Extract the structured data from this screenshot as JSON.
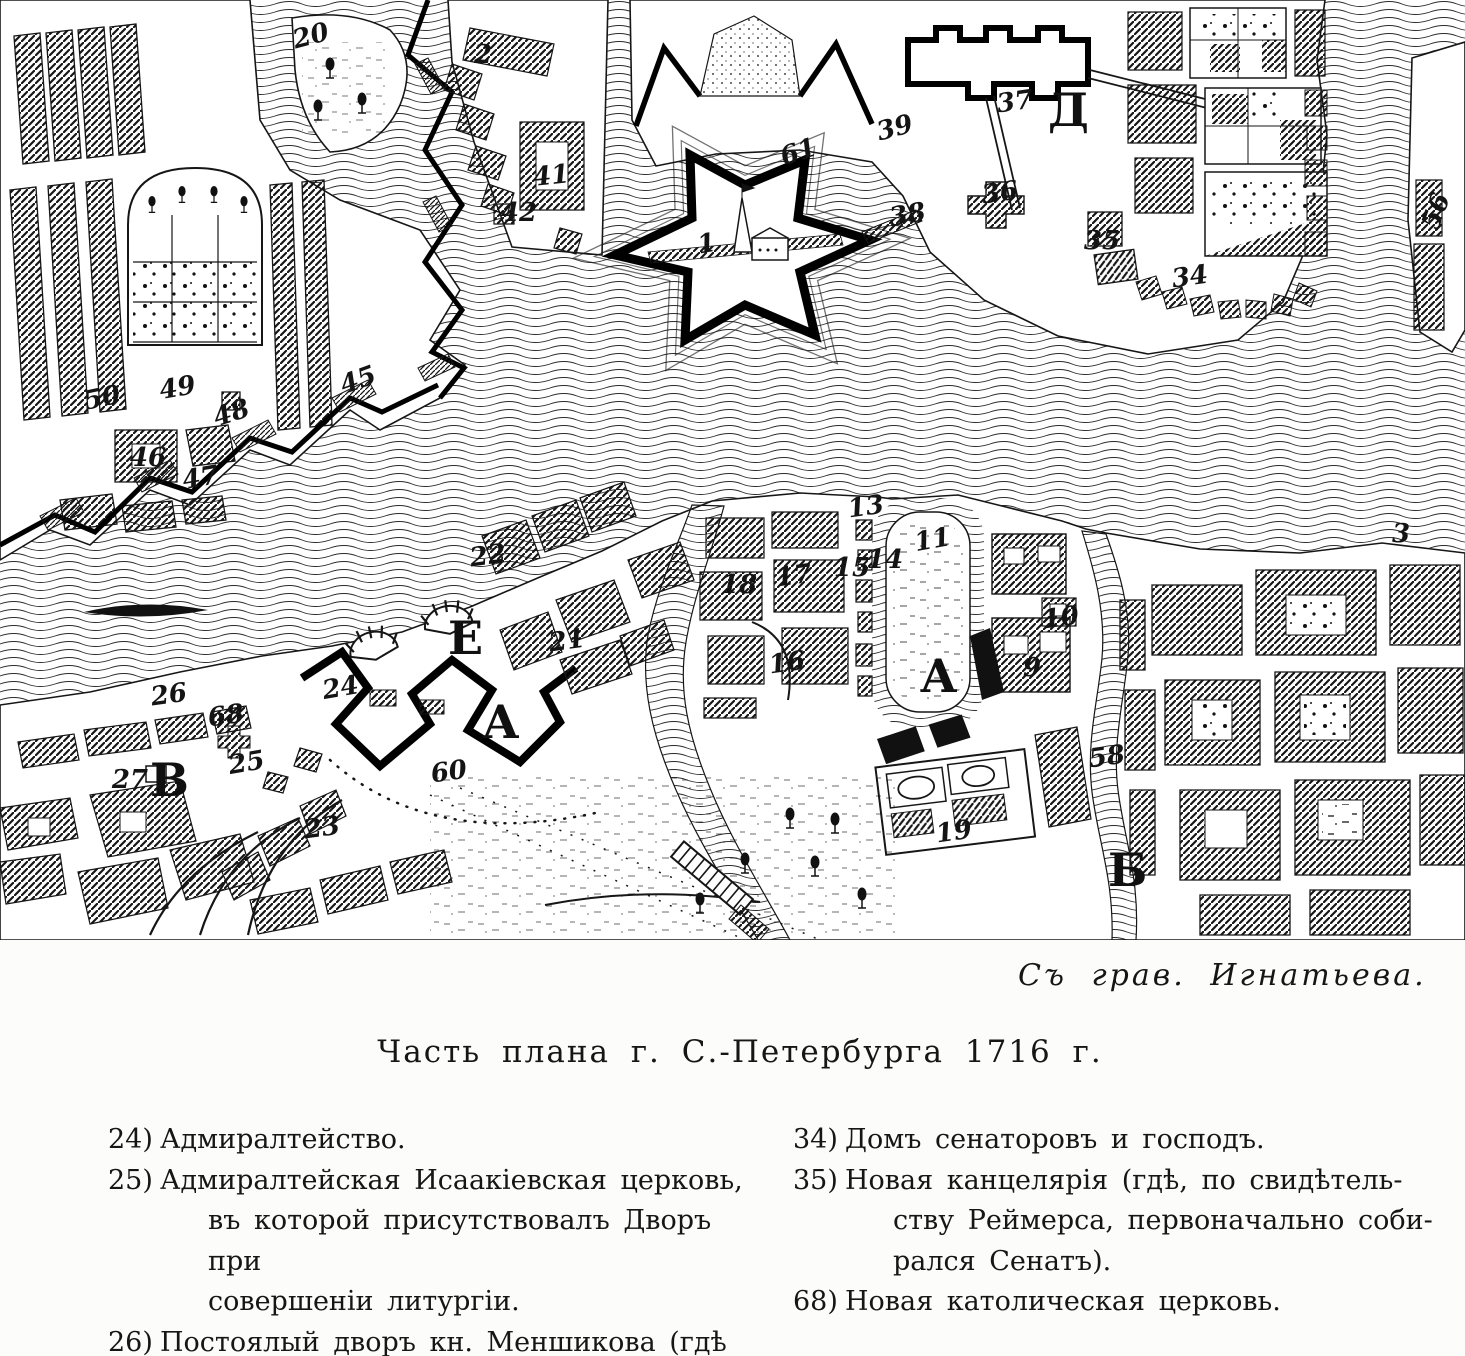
{
  "figure": {
    "attribution": "Съ грав. Игнатьева.",
    "title": "Часть плана г. С.-Петербурга 1716 г."
  },
  "colors": {
    "ink": "#161616",
    "paper": "#fcfcfa"
  },
  "legend": {
    "left": [
      {
        "num": "24)",
        "lines": [
          "Адмиралтейство."
        ]
      },
      {
        "num": "25)",
        "lines": [
          "Адмиралтейская Исаакіевская церковь,",
          "въ которой присутствовалъ Дворъ при",
          "совершеніи литургіи."
        ]
      },
      {
        "num": "26)",
        "lines": [
          "Постоялый дворъ кн. Меншикова (гдѣ",
          "нынѣ расположенъ Сенатъ)."
        ]
      }
    ],
    "right": [
      {
        "num": "34)",
        "lines": [
          "Домъ сенаторовъ и господъ."
        ]
      },
      {
        "num": "35)",
        "lines": [
          "Новая канцелярія (гдѣ, по свидѣтель-",
          "ству Реймерса, первоначально соби-",
          "рался Сенатъ)."
        ]
      },
      {
        "num": "68)",
        "lines": [
          "Новая католическая церковь."
        ]
      }
    ]
  },
  "map": {
    "labels": [
      {
        "t": "Д",
        "x": 1048,
        "y": 126,
        "k": "cap"
      },
      {
        "t": "Е",
        "x": 448,
        "y": 654,
        "k": "cap"
      },
      {
        "t": "А",
        "x": 482,
        "y": 738,
        "k": "cap"
      },
      {
        "t": "В",
        "x": 150,
        "y": 796,
        "k": "cap"
      },
      {
        "t": "А",
        "x": 920,
        "y": 692,
        "k": "cap",
        "s": 40
      },
      {
        "t": "Б",
        "x": 1108,
        "y": 886,
        "k": "cap"
      },
      {
        "t": "20",
        "x": 313,
        "y": 44,
        "k": "num",
        "r": -15
      },
      {
        "t": "2",
        "x": 483,
        "y": 63,
        "k": "num"
      },
      {
        "t": "41",
        "x": 552,
        "y": 184,
        "k": "num",
        "r": -6
      },
      {
        "t": "42",
        "x": 519,
        "y": 221,
        "k": "num"
      },
      {
        "t": "50",
        "x": 104,
        "y": 406,
        "k": "num",
        "r": -12
      },
      {
        "t": "49",
        "x": 179,
        "y": 396,
        "k": "num",
        "r": -10
      },
      {
        "t": "48",
        "x": 234,
        "y": 421,
        "k": "num",
        "r": -18
      },
      {
        "t": "46",
        "x": 148,
        "y": 466,
        "k": "num"
      },
      {
        "t": "47",
        "x": 202,
        "y": 486,
        "k": "num",
        "r": -10
      },
      {
        "t": "45",
        "x": 361,
        "y": 388,
        "k": "num",
        "r": -20
      },
      {
        "t": "1",
        "x": 708,
        "y": 252,
        "k": "num",
        "r": -10,
        "s": 30
      },
      {
        "t": "61",
        "x": 801,
        "y": 160,
        "k": "num",
        "r": -18,
        "s": 34
      },
      {
        "t": "39",
        "x": 897,
        "y": 136,
        "k": "num",
        "r": -15
      },
      {
        "t": "38",
        "x": 909,
        "y": 223,
        "k": "num",
        "r": -10
      },
      {
        "t": "37",
        "x": 1016,
        "y": 110,
        "k": "num",
        "r": -8,
        "s": 30
      },
      {
        "t": "36",
        "x": 1001,
        "y": 201,
        "k": "num",
        "r": -8
      },
      {
        "t": "35",
        "x": 1102,
        "y": 249,
        "k": "num",
        "s": 27
      },
      {
        "t": "34",
        "x": 1191,
        "y": 285,
        "k": "num",
        "r": -8,
        "s": 30
      },
      {
        "t": "56",
        "x": 1444,
        "y": 214,
        "k": "num",
        "r": -70
      },
      {
        "t": "3",
        "x": 1401,
        "y": 542,
        "k": "num"
      },
      {
        "t": "26",
        "x": 170,
        "y": 703,
        "k": "num",
        "r": -8
      },
      {
        "t": "68",
        "x": 227,
        "y": 724,
        "k": "num",
        "r": -8
      },
      {
        "t": "27",
        "x": 130,
        "y": 788,
        "k": "num"
      },
      {
        "t": "25",
        "x": 248,
        "y": 771,
        "k": "num",
        "r": -10
      },
      {
        "t": "23",
        "x": 323,
        "y": 836,
        "k": "num",
        "r": -8
      },
      {
        "t": "24",
        "x": 342,
        "y": 696,
        "k": "num",
        "r": -10
      },
      {
        "t": "60",
        "x": 450,
        "y": 780,
        "k": "num",
        "r": -8
      },
      {
        "t": "22",
        "x": 489,
        "y": 564,
        "k": "num",
        "r": -8
      },
      {
        "t": "21",
        "x": 568,
        "y": 649,
        "k": "num",
        "r": -8
      },
      {
        "t": "18",
        "x": 739,
        "y": 593,
        "k": "num"
      },
      {
        "t": "17",
        "x": 795,
        "y": 584,
        "k": "num",
        "r": -8
      },
      {
        "t": "15",
        "x": 852,
        "y": 576,
        "k": "num",
        "s": 22
      },
      {
        "t": "13",
        "x": 867,
        "y": 515,
        "k": "num",
        "r": -8,
        "s": 22
      },
      {
        "t": "14",
        "x": 885,
        "y": 568,
        "k": "num",
        "s": 22
      },
      {
        "t": "16",
        "x": 788,
        "y": 671,
        "k": "num",
        "r": -8
      },
      {
        "t": "11",
        "x": 934,
        "y": 548,
        "k": "num",
        "r": -10,
        "s": 28
      },
      {
        "t": "9",
        "x": 1032,
        "y": 676,
        "k": "num",
        "s": 28
      },
      {
        "t": "10",
        "x": 1062,
        "y": 626,
        "k": "num",
        "r": -8
      },
      {
        "t": "19",
        "x": 955,
        "y": 840,
        "k": "num",
        "r": -8,
        "s": 28
      },
      {
        "t": "58",
        "x": 1108,
        "y": 765,
        "k": "num",
        "r": -8
      }
    ]
  }
}
